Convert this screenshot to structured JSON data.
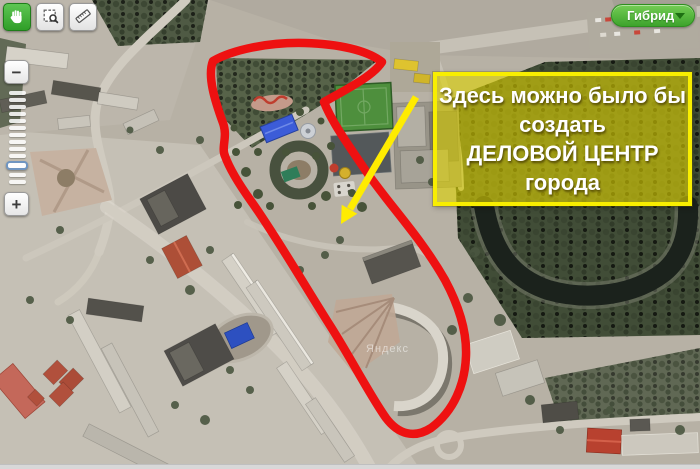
{
  "controls": {
    "toolbar": {
      "pan_tool": "pan-hand",
      "zoom_box_tool": "zoom-by-rectangle",
      "ruler_tool": "measure-distance"
    },
    "zoom": {
      "minus_label": "−",
      "plus_label": "+"
    },
    "layer_button": {
      "label": "Гибрид"
    }
  },
  "map": {
    "watermark": "Яндекс"
  },
  "annotation": {
    "outline_color": "#ee1111",
    "arrow_color": "#ffec00",
    "callout": {
      "fill_color": "#e0d400",
      "border_color": "#f8ee00",
      "text_color": "#ffffff",
      "line1": "Здесь можно было бы",
      "line2": "создать",
      "line3": "ДЕЛОВОЙ ЦЕНТР",
      "line4": "города"
    }
  }
}
